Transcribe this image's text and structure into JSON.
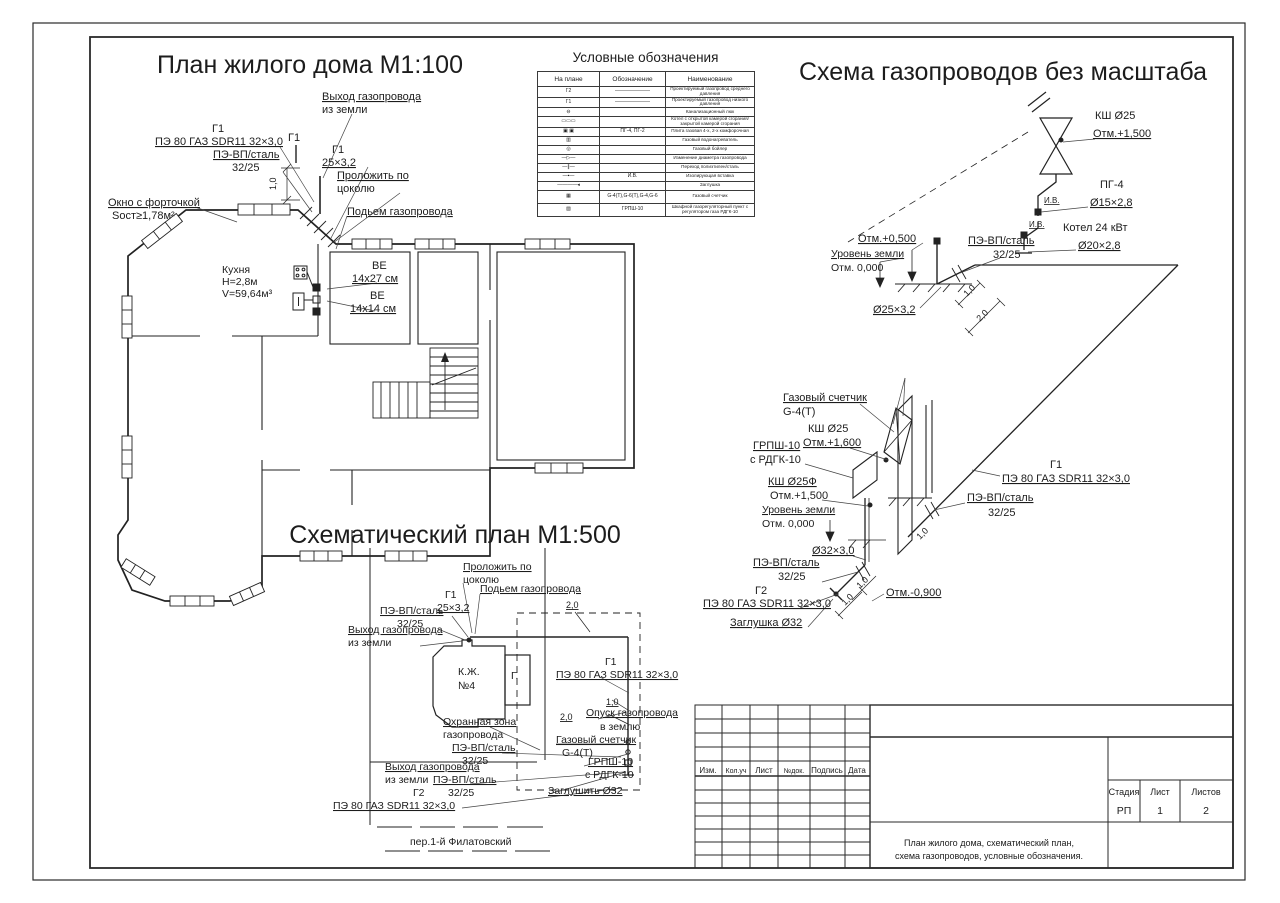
{
  "sheet": {
    "stage_label": "Стадия",
    "sheet_label": "Лист",
    "sheets_label": "Листов",
    "stage": "РП",
    "sheet_no": "1",
    "sheets_total": "2",
    "doc_title_line1": "План  жилого дома, схематический план,",
    "doc_title_line2": "схема газопроводов, условные обозначения.",
    "rev_cols": [
      "Изм.",
      "Кол.уч",
      "Лист",
      "№док.",
      "Подпись",
      "Дата"
    ]
  },
  "plan": {
    "title": "План жилого дома М1:100",
    "exit1": "Выход газопровода",
    "exit2": "из земли",
    "g1": "Г1",
    "pipe_pe": "ПЭ 80 ГАЗ SDR11 32×3,0",
    "pevp": "ПЭ-ВП/сталь",
    "pevp_size": "32/25",
    "d25": "25×3,2",
    "lay1": "Проложить по",
    "lay2": "цоколю",
    "rise": "Подьем газопровода",
    "window1": "Окно с форточкой",
    "window2": "Sост≥1,78м²",
    "kitchen1": "Кухня",
    "kitchen2": "Н=2,8м",
    "kitchen3": "V=59,64м³",
    "ve": "ВЕ",
    "ve_size1": "14х27 см",
    "ve_size2": "14х14 см",
    "dim10": "1,0"
  },
  "legend": {
    "title": "Условные обозначения",
    "headers": [
      "На плане",
      "Обозначение",
      "Наименование"
    ],
    "rows": [
      {
        "p": "Г2",
        "s": "———————",
        "n": "Проектируемый газопровод среднего давления"
      },
      {
        "p": "Г1",
        "s": "———————",
        "n": "Проектируемый газопровод низкого давления"
      },
      {
        "p": "⊖",
        "s": "",
        "n": "Канализационный люк"
      },
      {
        "p": "▭▭▭",
        "s": "",
        "n": "Котел с открытой камерой сгорания/закрытой камерой сгорания"
      },
      {
        "p": "▣ ▣",
        "s": "ПГ-4,  ПГ-2",
        "n": "Плита газовая 4-х, 2-х комфорочная"
      },
      {
        "p": "▥",
        "s": "",
        "n": "Газовый водонагреватель"
      },
      {
        "p": "◎",
        "s": "",
        "n": "Газовый бойлер"
      },
      {
        "p": "—▷—",
        "s": "",
        "n": "Изменение диаметра газопровода"
      },
      {
        "p": "—∥—",
        "s": "",
        "n": "Переход полиэтилен/сталь"
      },
      {
        "p": "—▪—",
        "s": "И.В.",
        "n": "Изолирующая вставка"
      },
      {
        "p": "————◂",
        "s": "",
        "n": "Заглушка"
      },
      {
        "p": "▦",
        "s": "G-4(Т),G-6(Т),G-4,G-6",
        "n": "Газовый счетчик"
      },
      {
        "p": "▨",
        "s": "ГРПШ-10",
        "n": "Шкафной газорегуляторный пункт с регулятором газа РДГК-10"
      }
    ]
  },
  "scheme": {
    "title": "Схема газопроводов без масштаба",
    "ksh25": "КШ Ø25",
    "otm1500": "Отм.+1,500",
    "pg4": "ПГ-4",
    "pg4_size": "Ø15×2,8",
    "iv": "И.В.",
    "boiler": "Котел 24 кВт",
    "boiler_size": "Ø20×2,8",
    "otm0500": "Отм.+0,500",
    "ground": "Уровень земли",
    "otm0": "Отм. 0,000",
    "pevp": "ПЭ-ВП/сталь",
    "pevp_size": "32/25",
    "d25": "Ø25×3,2",
    "dim10": "1,0",
    "dim20": "2,0",
    "meter1": "Газовый счетчик",
    "meter2": "G-4(Т)",
    "ksh25b": "КШ Ø25",
    "otm1600": "Отм.+1,600",
    "grpsh": "ГРПШ-10",
    "grpsh2": "с РДГК-10",
    "ksh25f": "КШ Ø25Ф",
    "otm1500b": "Отм.+1,500",
    "g1": "Г1",
    "pipe_pe": "ПЭ 80 ГАЗ SDR11 32×3,0",
    "d32": "Ø32×3,0",
    "g2": "Г2",
    "otm_m0900": "Отм.-0,900",
    "plug": "Заглушка Ø32"
  },
  "splan": {
    "title": "Схематический план М1:500",
    "lay1": "Проложить по",
    "lay2": "цоколю",
    "rise": "Подьем газопровода",
    "g1": "Г1",
    "d25": "25×3,2",
    "pevp": "ПЭ-ВП/сталь",
    "pevp_size": "32/25",
    "exit1": "Выход газопровода",
    "exit2": "из земли",
    "house1": "К.Ж.",
    "house2": "№4",
    "garage": "Г.",
    "pipe_pe": "ПЭ 80 ГАЗ SDR11 32×3,0",
    "dim10": "1,0",
    "dim20": "2,0",
    "drop1": "Опуск газопровода",
    "drop2": "в землю",
    "meter1": "Газовый счетчик",
    "meter2": "G-4(Т)",
    "grpsh": "ГРПШ-10",
    "grpsh2": "с РДГК-10",
    "plug": "Заглушить Ø32",
    "zone1": "Охранная зона",
    "zone2": "газопровода",
    "g2": "Г2",
    "street": "пер.1-й Филатовский"
  }
}
